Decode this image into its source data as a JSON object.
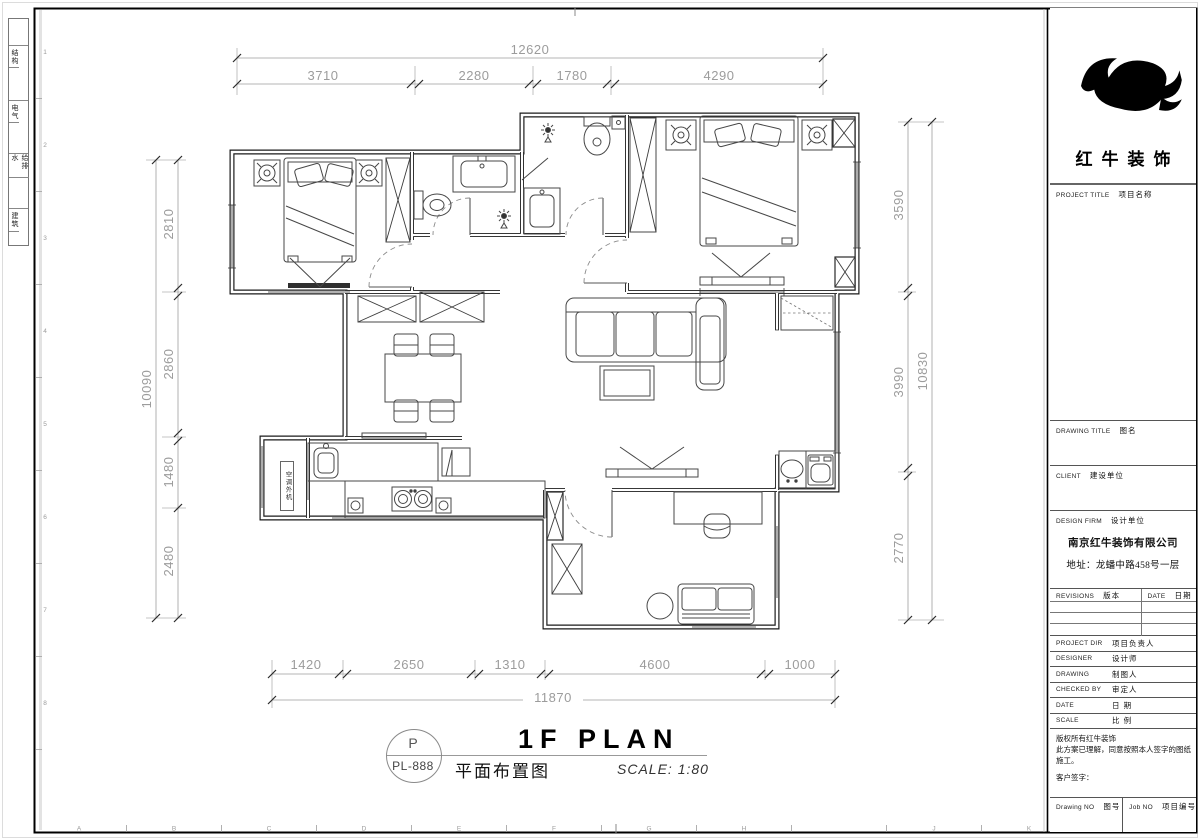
{
  "sheet": {
    "disciplines": [
      "结构",
      "电气",
      "给排水",
      "建筑"
    ],
    "grid_letters": [
      "A",
      "B",
      "C",
      "D",
      "E",
      "F",
      "G",
      "H",
      "J",
      "K"
    ],
    "grid_numbers": [
      "1",
      "2",
      "3",
      "4",
      "5",
      "6",
      "7",
      "8"
    ]
  },
  "dimensions": {
    "top": {
      "overall": "12620",
      "segments": [
        "3710",
        "2280",
        "1780",
        "4290"
      ]
    },
    "left": {
      "overall": "10090",
      "segments": [
        "2810",
        "2860",
        "1480",
        "2480"
      ]
    },
    "right": {
      "overall": "10830",
      "segments": [
        "3590",
        "3990",
        "2770"
      ]
    },
    "bottom": {
      "overall": "11870",
      "segments": [
        "1420",
        "2650",
        "1310",
        "4600",
        "1000"
      ]
    }
  },
  "plan": {
    "ac_unit_label": "空调外机"
  },
  "drawing_title": {
    "tag_letter": "P",
    "tag_number": "PL-888",
    "title_en": "1F PLAN",
    "title_cn": "平面布置图",
    "scale": "SCALE: 1:80"
  },
  "titleblock": {
    "brand": "红牛装饰",
    "fields": [
      {
        "en": "PROJECT TITLE",
        "cn": "项目名称"
      },
      {
        "en": "DRAWING TITLE",
        "cn": "图名"
      },
      {
        "en": "CLIENT",
        "cn": "建设单位"
      },
      {
        "en": "DESIGN FIRM",
        "cn": "设计单位"
      }
    ],
    "company": "南京红牛装饰有限公司",
    "address": "地址：龙蟠中路458号一层",
    "rev": {
      "en_left": "REVISIONS",
      "cn_left": "版本",
      "en_right": "DATE",
      "cn_right": "日期"
    },
    "rows": [
      {
        "en": "PROJECT DIR",
        "cn": "项目负责人"
      },
      {
        "en": "DESIGNER",
        "cn": "设计师"
      },
      {
        "en": "DRAWING",
        "cn": "制图人"
      },
      {
        "en": "CHECKED BY",
        "cn": "审定人"
      },
      {
        "en": "DATE",
        "cn": "日  期"
      },
      {
        "en": "SCALE",
        "cn": "比  例"
      }
    ],
    "notice1": "版权所有红牛装饰",
    "notice2": "此方案已理解，同意按照本人签字的图纸施工。",
    "signature": "客户签字：",
    "bottom_left_en": "Drawing NO",
    "bottom_left_cn": "图号",
    "bottom_right_en": "Job NO",
    "bottom_right_cn": "项目编号"
  }
}
